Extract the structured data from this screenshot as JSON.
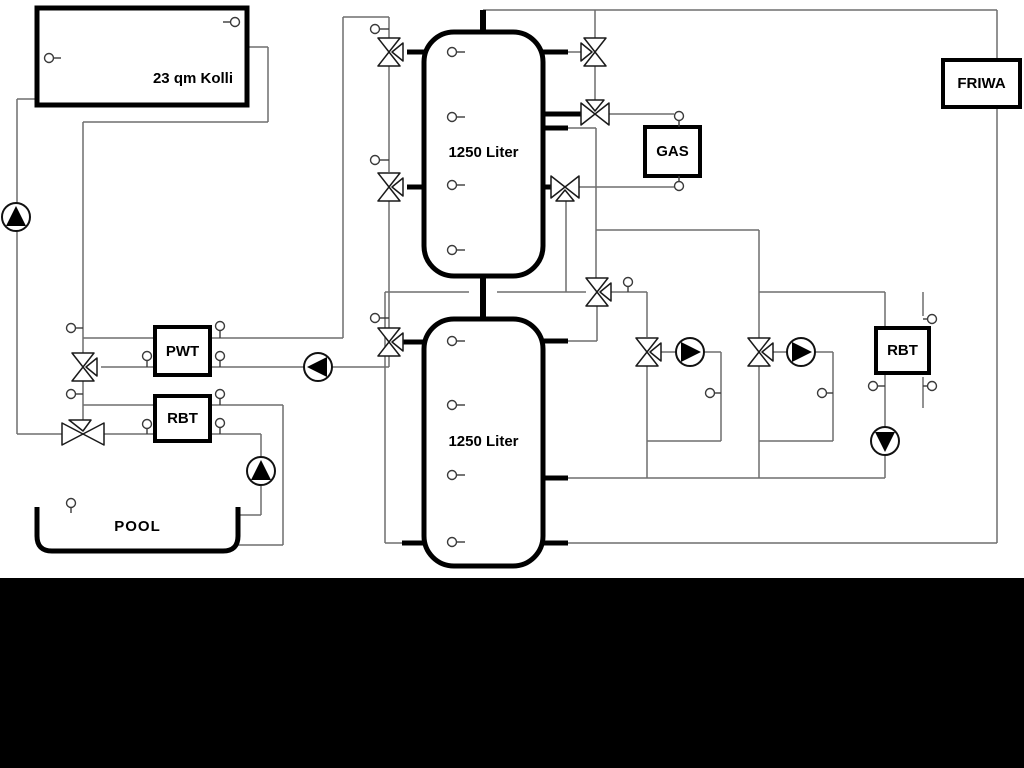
{
  "app": {
    "background": "#ffffff",
    "letterbox_color": "#000000"
  },
  "components": {
    "collector": {
      "label": "23 qm Kolli"
    },
    "buffer_tank_top": {
      "label": "1250 Liter"
    },
    "buffer_tank_bottom": {
      "label": "1250 Liter"
    },
    "gas_boiler": {
      "label": "GAS"
    },
    "fresh_water_station": {
      "label": "FRIWA"
    },
    "heat_exchanger": {
      "label": "PWT"
    },
    "return_limiter_pool": {
      "label": "RBT"
    },
    "return_limiter_right": {
      "label": "RBT"
    },
    "pool": {
      "label": "POOL"
    }
  },
  "symbols": {
    "pumps": [
      {
        "id": "collector-pump",
        "direction": "up"
      },
      {
        "id": "pwt-primary-pump",
        "direction": "left"
      },
      {
        "id": "pool-pump",
        "direction": "up"
      },
      {
        "id": "circuit-pump-1",
        "direction": "right"
      },
      {
        "id": "circuit-pump-2",
        "direction": "right"
      },
      {
        "id": "rbt-return-pump",
        "direction": "down"
      }
    ],
    "three_way_valve_count": 9,
    "sensor_count": 30
  },
  "colors": {
    "pipe": "#6e6e6e",
    "symbol_stroke": "#1a1a1a",
    "component_stroke": "#000000"
  }
}
